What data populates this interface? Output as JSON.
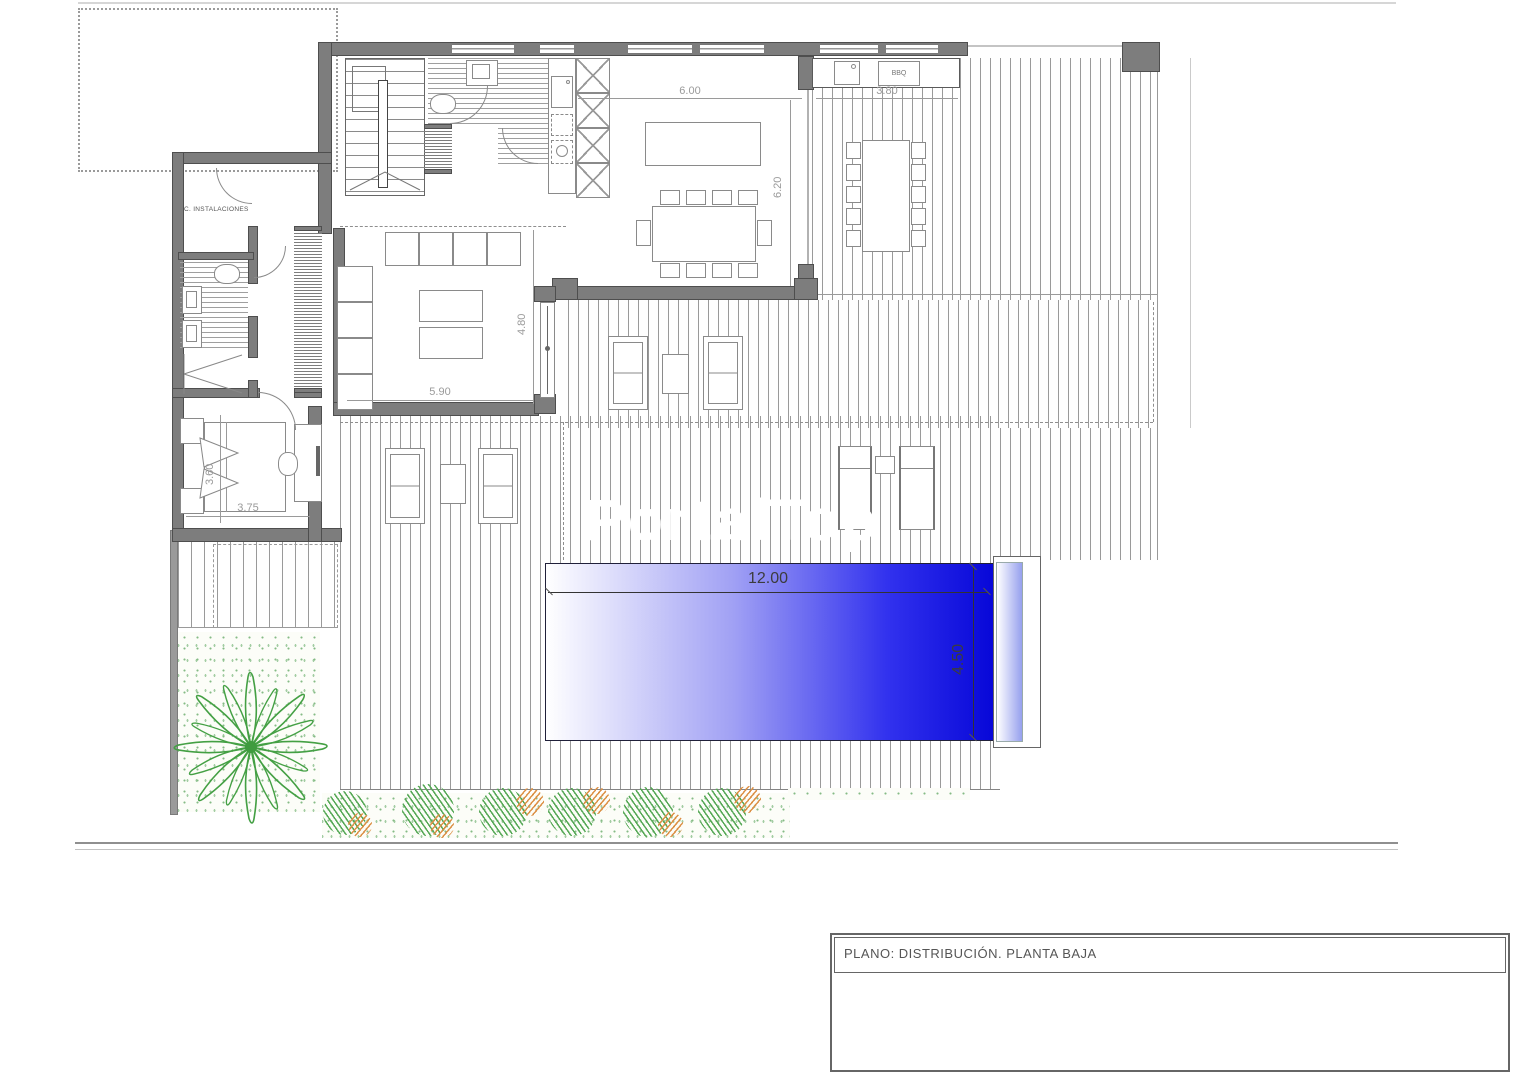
{
  "texts": {
    "plan_title": "PLANO: DISTRIBUCIÓN. PLANTA BAJA",
    "watermark": "PortalTop",
    "room_installations": "C. INSTALACIONES",
    "bbq": "BBQ"
  },
  "dimensions": {
    "kitchen_width": "6.00",
    "outdoor_kitchen_width": "3.80",
    "kitchen_depth": "6.20",
    "lounge_depth": "4.80",
    "lounge_width": "5.90",
    "bedroom_depth": "3.60",
    "bedroom_width": "3.75",
    "pool_length": "12.00",
    "pool_width": "4.50"
  },
  "colors": {
    "pool_deep_blue": "#0707d8",
    "wall_gray": "#7d7d7d",
    "plant_green": "#44a044",
    "shrub_orange": "#dc9045"
  }
}
